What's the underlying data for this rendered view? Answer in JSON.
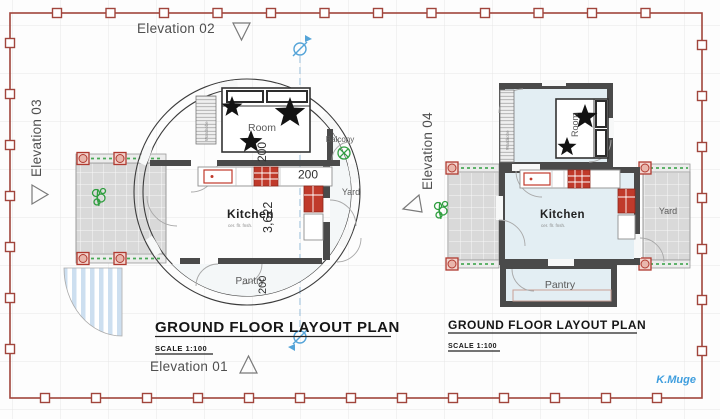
{
  "sheet": {
    "signature": "K.Muge"
  },
  "elevations": {
    "e01": "Elevation 01",
    "e02": "Elevation 02",
    "e03": "Elevation 03",
    "e04": "Elevation 04"
  },
  "plan_circular": {
    "title": "GROUND FLOOR LAYOUT PLAN",
    "scale": "SCALE 1:100",
    "labels": {
      "room": "Room",
      "kitchen": "Kitchen",
      "kitchen_finish": "cer. flr. fnsh.",
      "pantry": "Pantry",
      "yard": "Yard",
      "balcony": "Balcony",
      "wardrobe": "Wardrobe"
    },
    "dimensions": {
      "room": "200",
      "yard": "200",
      "kitchen": "3,622",
      "pantry": "200"
    }
  },
  "plan_rect": {
    "title": "GROUND FLOOR LAYOUT PLAN",
    "scale": "SCALE 1:100",
    "labels": {
      "room": "Room",
      "kitchen": "Kitchen",
      "kitchen_finish": "cer. flr. fnsh.",
      "pantry": "Pantry",
      "yard": "Yard",
      "wardrobe": "Wardrobe"
    }
  },
  "colors": {
    "border": "#a1453c",
    "floor": "#e3eef3",
    "wall": "#4a4a4a",
    "fixture_red": "#c03a2b",
    "column_red": "#b03a30",
    "plant_green": "#2f9e3f",
    "section_blue": "#55a4d8",
    "signature_blue": "#3f9ede"
  }
}
